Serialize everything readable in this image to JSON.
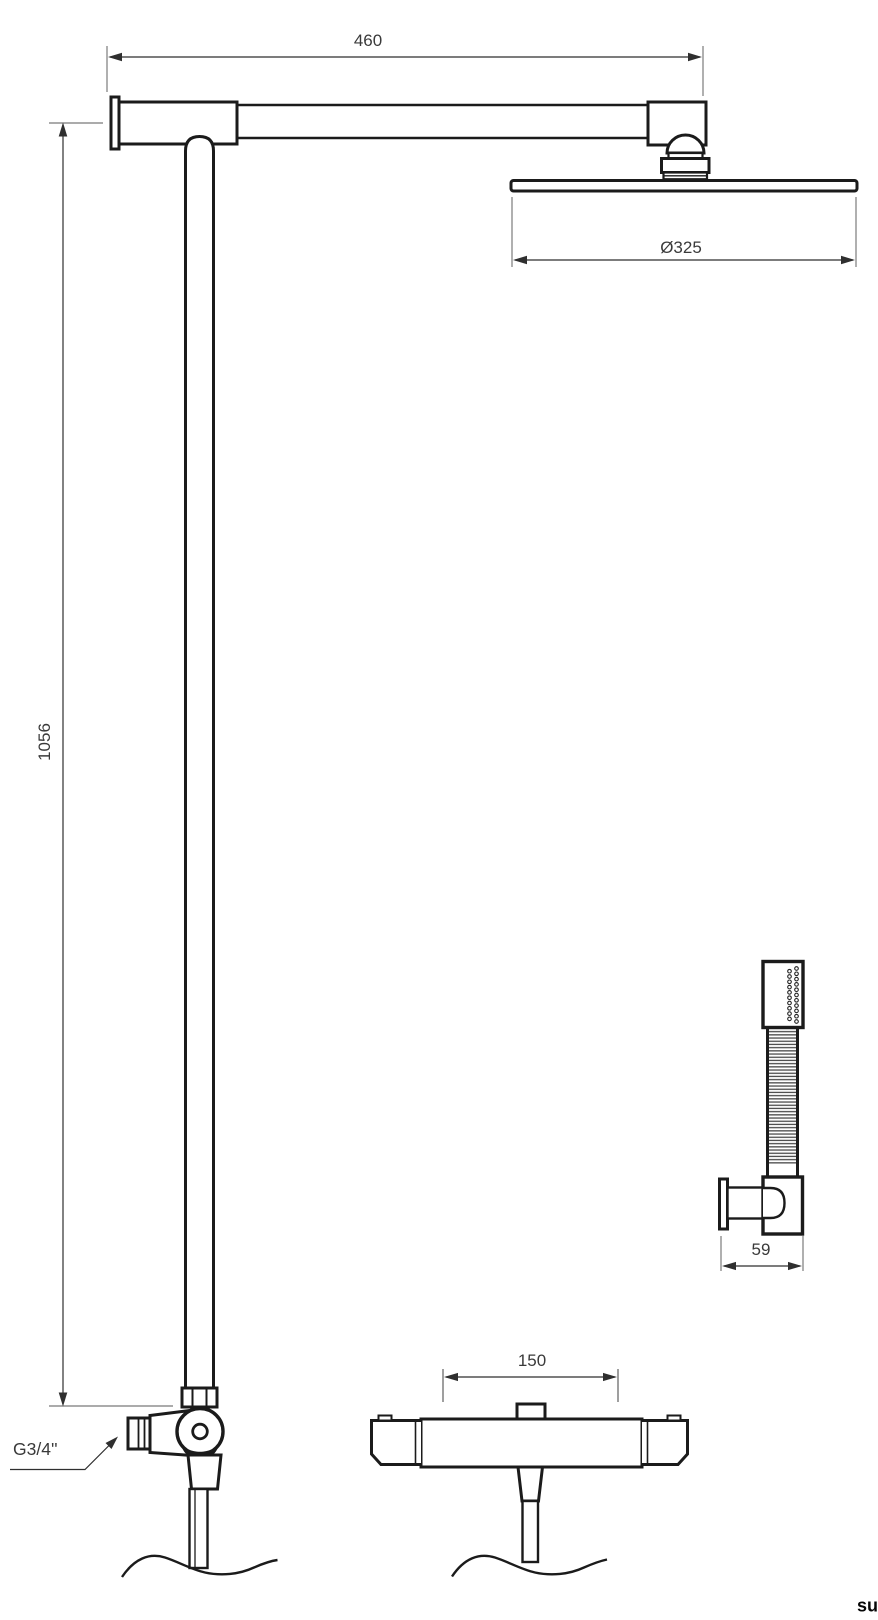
{
  "drawing": {
    "kind": "shower-system-technical-dimension-drawing",
    "background": "#ffffff",
    "stroke_color": "#1b1b1b",
    "extension_line_color": "#8f8f8f",
    "text_color": "#3a3a3a"
  },
  "dimensions": {
    "arm_length": "460",
    "head_diameter": "Ø325",
    "column_height": "1056",
    "handset_bracket_depth": "59",
    "mixer_inlet_spacing": "150"
  },
  "labels": {
    "inlet_thread": "G3/4''"
  },
  "watermark": "su"
}
